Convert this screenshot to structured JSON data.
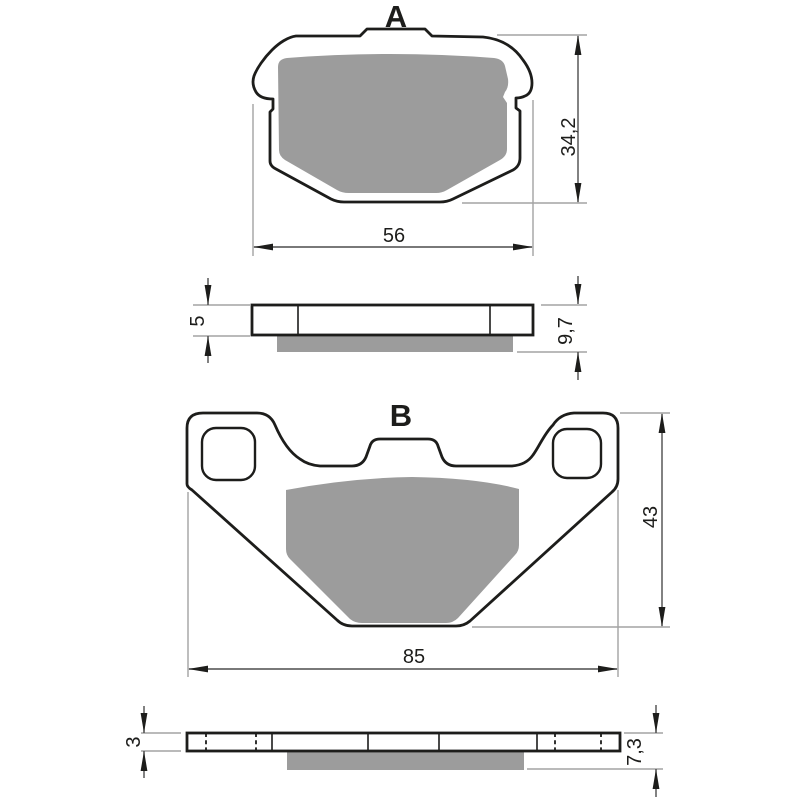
{
  "drawing": {
    "type": "brake-pad-technical-drawing",
    "units_style": "comma-decimal",
    "colors": {
      "background": "#ffffff",
      "outline": "#1d1d1b",
      "friction_material": "#9c9c9c",
      "dimension_line": "#4d4d4d",
      "extension_line": "#a3a3a3"
    },
    "views": {
      "pad_a": {
        "label": "A",
        "width": "56",
        "height": "34,2"
      },
      "side_a": {
        "backing_thickness": "5",
        "total_thickness": "9,7"
      },
      "pad_b": {
        "label": "B",
        "width": "85",
        "height": "43"
      },
      "side_b": {
        "backing_thickness": "3",
        "total_thickness": "7,3"
      }
    }
  }
}
